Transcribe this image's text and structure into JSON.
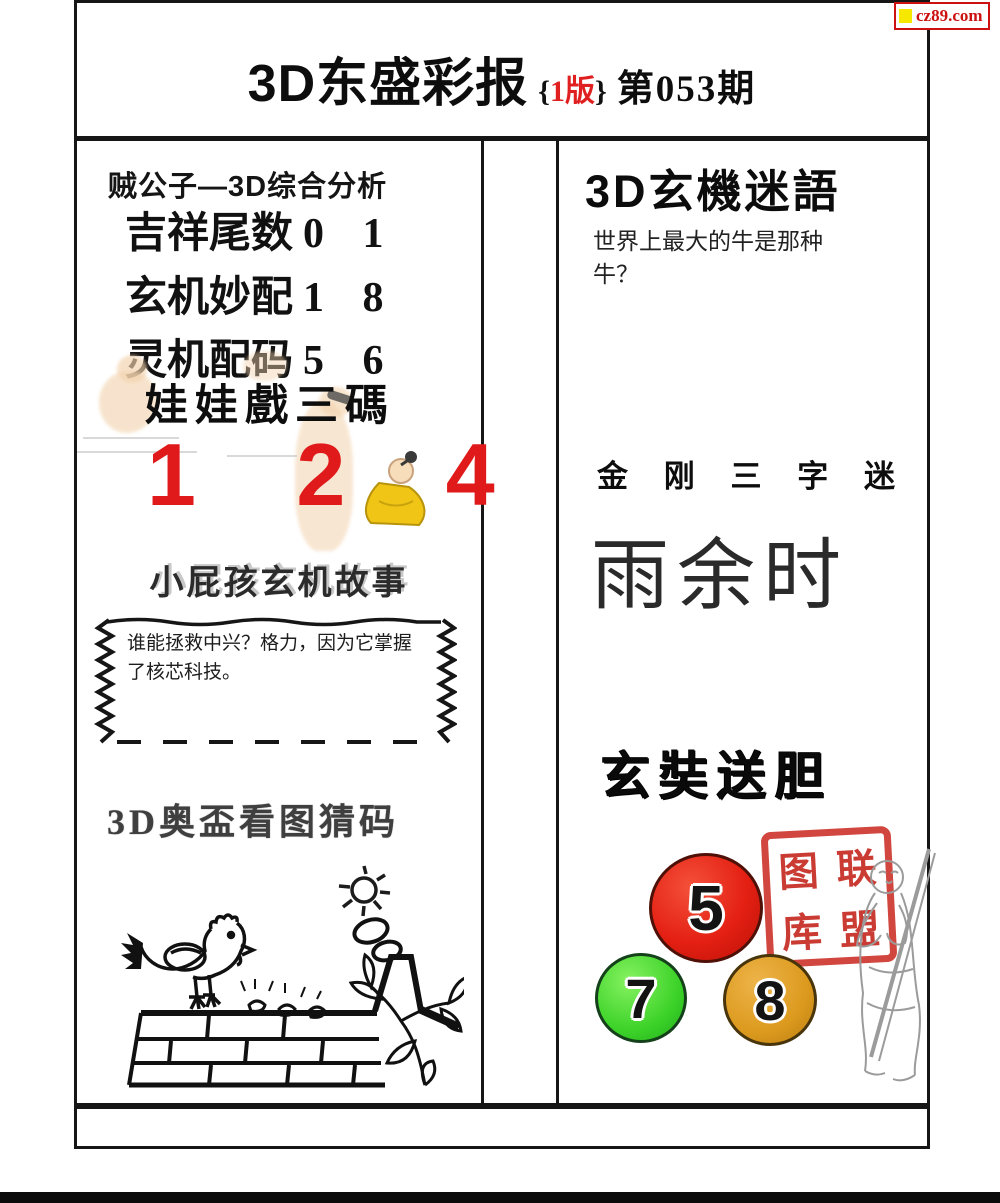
{
  "badge": {
    "label": "cz89.com",
    "square_color": "#f6e800",
    "text_color": "#cc1111"
  },
  "header": {
    "title": "3D东盛彩报",
    "edition_open": "{",
    "edition_text": "1版",
    "edition_close": "}",
    "edition_color": "#e02020",
    "issue": "第053期"
  },
  "left": {
    "analysis_title": "贼公子—3D综合分析",
    "analysis_rows": [
      {
        "label": "吉祥尾数",
        "value": "0 1"
      },
      {
        "label": "玄机妙配",
        "value": "1 8"
      },
      {
        "label": "灵机配码",
        "value": "5 6"
      }
    ],
    "wawa_title": "娃娃戲三碼",
    "wawa_numbers": "1 2 4",
    "wawa_numbers_color": "#e01a1a",
    "story_title": "小屁孩玄机故事",
    "story_text": "谁能拯救中兴？格力，因为它掌握了核芯科技。",
    "picture_title": "3D奥盃看图猜码"
  },
  "right": {
    "riddle_title": "3D玄機迷語",
    "riddle_question": "世界上最大的牛是那种牛？",
    "three_char_title": "金 刚 三 字 迷",
    "three_char_answer": "雨余时",
    "dan_title": "玄奘送胆",
    "balls": [
      {
        "number": "5",
        "color": "#e42013"
      },
      {
        "number": "7",
        "color": "#3ed32a"
      },
      {
        "number": "8",
        "color": "#dc9a1e"
      }
    ],
    "seal_chars": [
      "图",
      "联",
      "库",
      "盟"
    ],
    "seal_color": "#c5281e"
  }
}
